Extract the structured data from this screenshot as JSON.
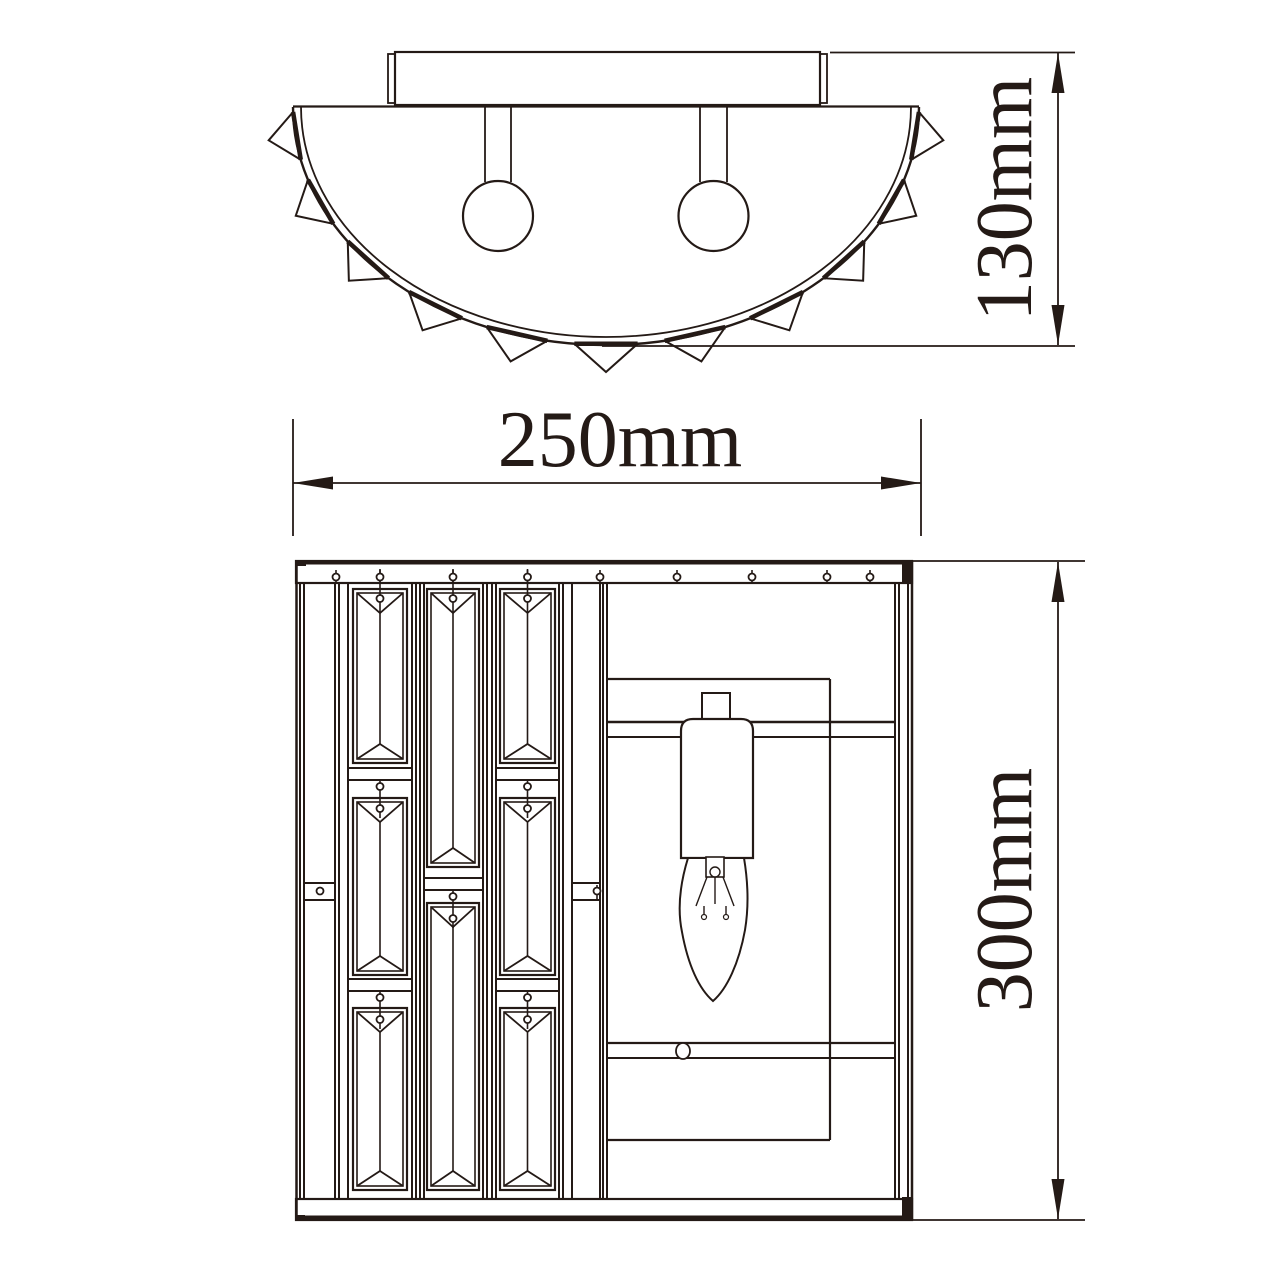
{
  "drawing": {
    "background": "#ffffff",
    "line_color": "#241a16",
    "dimensions": {
      "width_label": "250mm",
      "height_top_label": "130mm",
      "height_front_label": "300mm"
    }
  }
}
